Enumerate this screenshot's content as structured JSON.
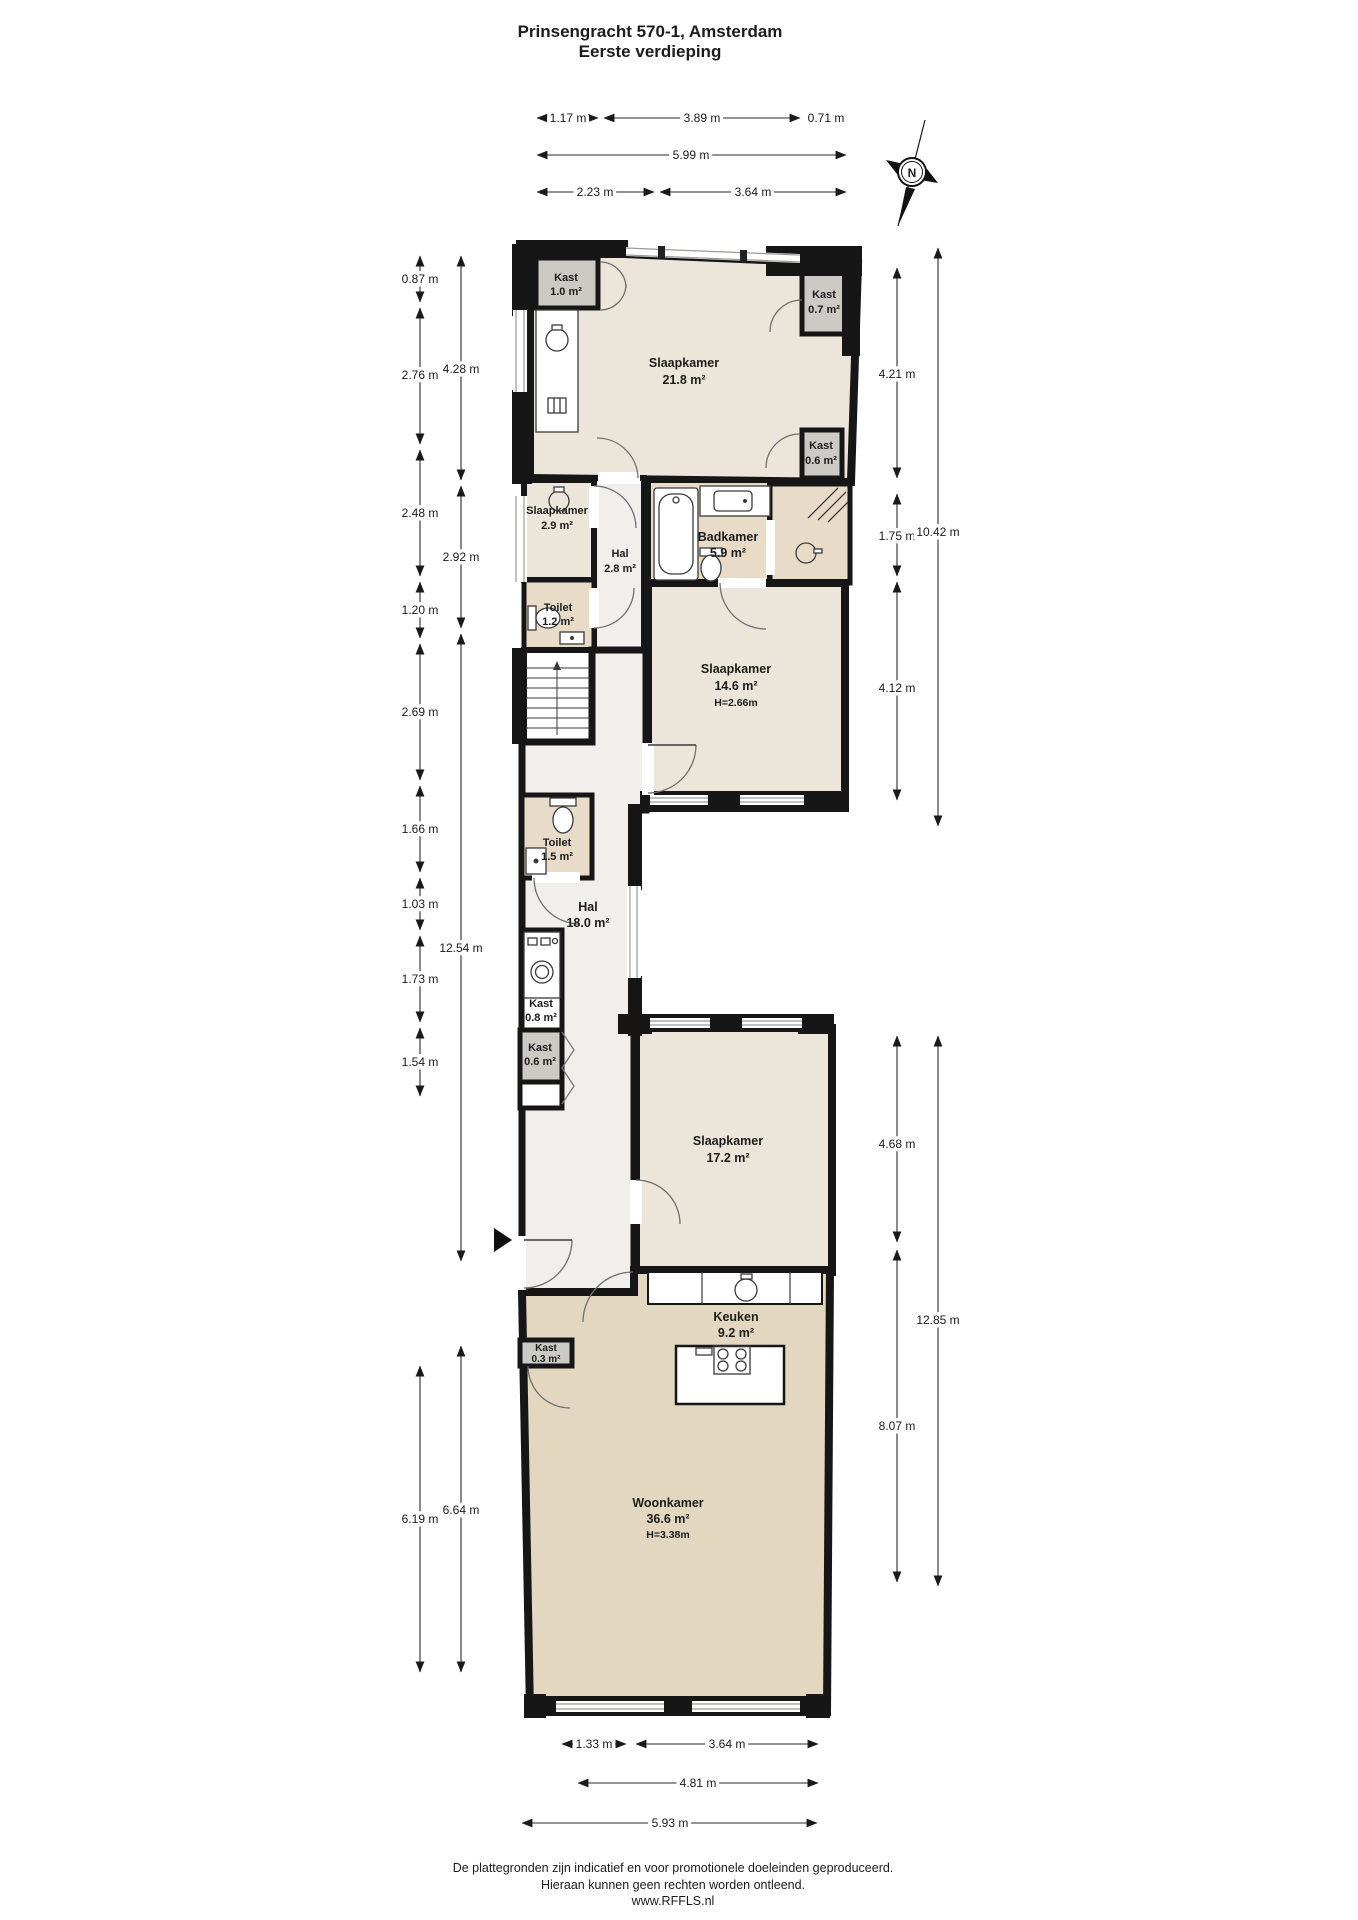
{
  "header": {
    "title_line1": "Prinsengracht 570-1, Amsterdam",
    "title_line2": "Eerste verdieping"
  },
  "compass": {
    "label": "N"
  },
  "rooms": {
    "kast_1_0": {
      "name": "Kast",
      "area": "1.0 m²"
    },
    "slaapkamer_21_8": {
      "name": "Slaapkamer",
      "area": "21.8 m²"
    },
    "kast_0_7": {
      "name": "Kast",
      "area": "0.7 m²"
    },
    "kast_0_6_boven": {
      "name": "Kast",
      "area": "0.6 m²"
    },
    "slaapkamer_2_9": {
      "name": "Slaapkamer",
      "area": "2.9 m²"
    },
    "hal_2_8": {
      "name": "Hal",
      "area": "2.8 m²"
    },
    "badkamer_5_9": {
      "name": "Badkamer",
      "area": "5.9 m²"
    },
    "toilet_1_2": {
      "name": "Toilet",
      "area": "1.2 m²"
    },
    "slaapkamer_14_6": {
      "name": "Slaapkamer",
      "area": "14.6 m²",
      "height": "H=2.66m"
    },
    "toilet_1_5": {
      "name": "Toilet",
      "area": "1.5 m²"
    },
    "hal_18_0": {
      "name": "Hal",
      "area": "18.0 m²"
    },
    "kast_0_8": {
      "name": "Kast",
      "area": "0.8 m²"
    },
    "kast_0_6_onder": {
      "name": "Kast",
      "area": "0.6 m²"
    },
    "slaapkamer_17_2": {
      "name": "Slaapkamer",
      "area": "17.2 m²"
    },
    "keuken_9_2": {
      "name": "Keuken",
      "area": "9.2 m²"
    },
    "kast_0_3": {
      "name": "Kast",
      "area": "0.3 m²"
    },
    "woonkamer_36_6": {
      "name": "Woonkamer",
      "area": "36.6 m²",
      "height": "H=3.38m"
    }
  },
  "dimensions": {
    "top": {
      "row1": [
        "1.17 m",
        "3.89 m",
        "0.71 m"
      ],
      "row2": [
        "5.99 m"
      ],
      "row3": [
        "2.23 m",
        "3.64 m"
      ]
    },
    "left_outer": [
      "0.87 m",
      "2.76 m",
      "2.48 m",
      "1.20 m",
      "2.69 m",
      "1.66 m",
      "1.03 m",
      "1.73 m",
      "1.54 m",
      "6.19 m"
    ],
    "left_inner": [
      "4.28 m",
      "2.92 m",
      "12.54 m",
      "6.64 m"
    ],
    "right_inner": [
      "4.21 m",
      "1.75 m",
      "4.12 m",
      "4.68 m",
      "8.07 m"
    ],
    "right_outer": [
      "10.42 m",
      "12.85 m"
    ],
    "bottom": {
      "row1": [
        "1.33 m",
        "3.64 m"
      ],
      "row2": [
        "4.81 m"
      ],
      "row3": [
        "5.93 m"
      ]
    }
  },
  "footer": {
    "line1": "De plattegronden zijn indicatief en voor promotionele doeleinden geproduceerd.",
    "line2": "Hieraan kunnen geen rechten worden ontleend.",
    "line3": "www.RFFLS.nl"
  },
  "colors": {
    "wall": "#161616",
    "room_beige": "#ece6da",
    "room_tan": "#e8dcc8",
    "living_tan": "#e3d7c0",
    "closet_gray": "#cbcac4",
    "hall_white": "#f1efeb",
    "window_line": "#9a9a96"
  }
}
